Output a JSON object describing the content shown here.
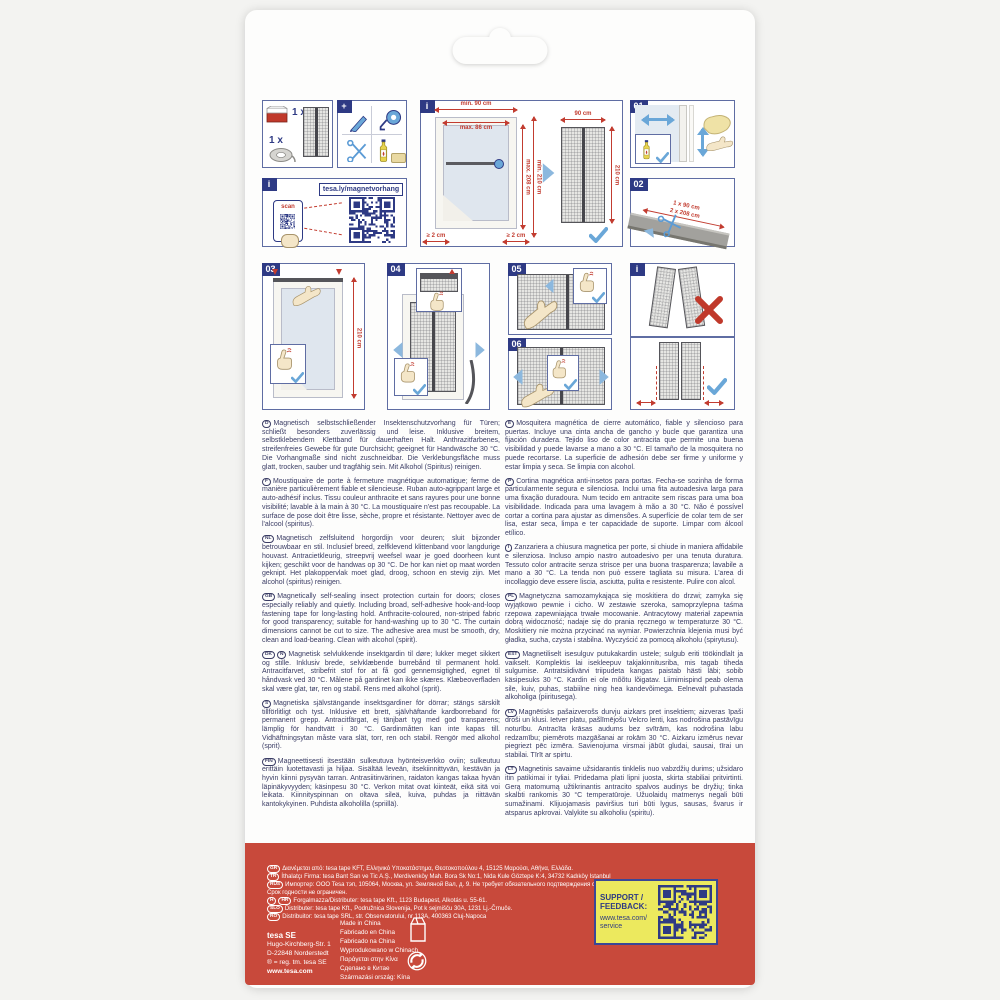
{
  "colors": {
    "footer_red": "#c8493b",
    "panel_navy": "#2e3a84",
    "dim_red": "#c23c30",
    "arrow_blue": "#6aa7d8",
    "support_yellow": "#ece95e",
    "text_navy": "#3a3c64"
  },
  "panels": {
    "contents": {
      "qty_curtain": "1 x",
      "qty_tape": "1 x"
    },
    "tools": {
      "plus": "+"
    },
    "qr": {
      "badge": "i",
      "url": "tesa.ly/magnetvorhang",
      "scan": "scan"
    },
    "measure": {
      "badge": "i",
      "min_width": "min. 90 cm",
      "max_width": "max. 86 cm",
      "min_height": "min. 210 cm",
      "max_height": "max. 208 cm",
      "gap_left": "≥ 2 cm",
      "gap_right": "≥ 2 cm",
      "curtain_width": "90 cm",
      "curtain_height": "210 cm"
    },
    "step01": {
      "num": "01"
    },
    "step02": {
      "num": "02",
      "cut_width": "1 x 90 cm",
      "cut_height": "2 x 208 cm"
    },
    "step03": {
      "num": "03",
      "height": "210 cm"
    },
    "step04": {
      "num": "04"
    },
    "step05": {
      "num": "05"
    },
    "step06": {
      "num": "06"
    },
    "hint": {
      "badge": "i"
    }
  },
  "descriptions": [
    {
      "lang": "D",
      "text": "Magnetisch selbstschließender Insektenschutzvorhang für Türen; schließt besonders zuverlässig und leise. Inklusive breitem, selbstklebendem Klettband für dauerhaften Halt. Anthrazitfarbenes, streifenfreies Gewebe für gute Durchsicht; geeignet für Handwäsche 30 °C. Die Vorhangmaße sind nicht zuschneidbar. Die Verklebungsfläche muss glatt, trocken, sauber und tragfähig sein. Mit Alkohol (Spiritus) reinigen."
    },
    {
      "lang": "F",
      "text": "Moustiquaire de porte à fermeture magnétique automatique; ferme de manière particulièrement fiable et silencieuse. Ruban auto-agrippant large et auto-adhésif inclus. Tissu couleur anthracite et sans rayures pour une bonne visibilité; lavable à la main à 30 °C. La moustiquaire n'est pas recoupable. La surface de pose doit être lisse, sèche, propre et résistante. Nettoyer avec de l'alcool (spiritus)."
    },
    {
      "lang": "NL",
      "text": "Magnetisch zelfsluitend horgordijn voor deuren; sluit bijzonder betrouwbaar en stil. Inclusief breed, zelfklevend klittenband voor langdurige houvast. Antracietkleurig, streepvrij weefsel waar je goed doorheen kunt kijken; geschikt voor de handwas op 30 °C. De hor kan niet op maat worden geknipt. Het plakoppervlak moet glad, droog, schoon en stevig zijn. Met alcohol (spiritus) reinigen."
    },
    {
      "lang": "GB",
      "text": "Magnetically self-sealing insect protection curtain for doors; closes especially reliably and quietly. Including broad, self-adhesive hook-and-loop fastening tape for long-lasting hold. Anthracite-coloured, non-striped fabric for good transparency; suitable for hand-washing up to 30 °C. The curtain dimensions cannot be cut to size. The adhesive area must be smooth, dry, clean and load-bearing. Clean with alcohol (spirit)."
    },
    {
      "lang": "DK",
      "lang2": "N",
      "text": "Magnetisk selvlukkende insektgardin til døre; lukker meget sikkert og stille. Inklusiv brede, selvklæbende burrebånd til permanent hold. Antracitfarvet, stribefrit stof for at få god gennemsigtighed, egnet til håndvask ved 30 °C. Målene på gardinet kan ikke skæres. Klæbeoverfladen skal være glat, tør, ren og stabil. Rens med alkohol (sprit)."
    },
    {
      "lang": "S",
      "text": "Magnetiska självstängande insektsgardiner för dörrar; stängs särskilt tillförlitligt och tyst. Inklusive ett brett, självhäftande kardborreband för permanent grepp. Antracitfärgat, ej tänjbart tyg med god transparens; lämplig för handtvätt i 30 °C. Gardinmåtten kan inte kapas till. Vidhäftningsytan måste vara slät, torr, ren och stabil. Rengör med alkohol (sprit)."
    },
    {
      "lang": "FIN",
      "text": "Magneettisesti itsestään sulkeutuva hyönteisverkko oviin; sulkeutuu erittäin luotettavasti ja hiljaa. Sisältää leveän, itsekiinnittyvän, kestävän ja hyvin kiinni pysyvän tarran. Antrasiitinvärinen, raidaton kangas takaa hyvän läpinäkyvyyden; käsinpesu 30 °C. Verkon mitat ovat kiinteät, eikä sitä voi leikata. Kiinnityspinnan on oltava sileä, kuiva, puhdas ja riittävän kantokykyinen. Puhdista alkoholilla (spriillä)."
    },
    {
      "lang": "E",
      "text": "Mosquitera magnética de cierre automático, fiable y silencioso para puertas. Incluye una cinta ancha de gancho y bucle que garantiza una fijación duradera. Tejido liso de color antracita que permite una buena visibilidad y puede lavarse a mano a 30 °C. El tamaño de la mosquitera no puede recortarse. La superficie de adhesión debe ser firme y uniforme y estar limpia y seca. Se limpia con alcohol."
    },
    {
      "lang": "P",
      "text": "Cortina magnética anti-insetos para portas. Fecha-se sozinha de forma particularmente segura e silenciosa. Inclui uma fita autoadesiva larga para uma fixação duradoura. Num tecido em antracite sem riscas para uma boa visibilidade. Indicada para uma lavagem à mão a 30 °C. Não é possível cortar a cortina para ajustar as dimensões. A superfície de colar tem de ser lisa, estar seca, limpa e ter capacidade de suporte. Limpar com álcool etílico."
    },
    {
      "lang": "I",
      "text": "Zanzariera a chiusura magnetica per porte, si chiude in maniera affidabile e silenziosa. Incluso ampio nastro autoadesivo per una tenuta duratura. Tessuto color antracite senza strisce per una buona trasparenza; lavabile a mano a 30 °C. La tenda non può essere tagliata su misura. L'area di incollaggio deve essere liscia, asciutta, pulita e resistente. Pulire con alcol."
    },
    {
      "lang": "PL",
      "text": "Magnetyczna samozamykająca się moskitiera do drzwi; zamyka się wyjątkowo pewnie i cicho. W zestawie szeroka, samoprzylepna taśma rzepowa zapewniająca trwałe mocowanie. Antracytowy materiał zapewnia dobrą widoczność; nadaje się do prania ręcznego w temperaturze 30 °C. Moskitiery nie można przycinać na wymiar. Powierzchnia klejenia musi być gładka, sucha, czysta i stabilna. Wyczyścić za pomocą alkoholu (spirytusu)."
    },
    {
      "lang": "EST",
      "text": "Magnetiliselt isesulguv putukakardin ustele; sulgub eriti töökindlalt ja vaikselt. Komplektis lai isekleepuv takjakinnitusriba, mis tagab tiheda sulgumise. Antratsiidivärvi triipudeta kangas paistab hästi läbi; sobib käsipesuks 30 °C. Kardin ei ole mõõtu lõigatav. Liimimispind peab olema sile, kuiv, puhas, stabiilne ning hea kandevõimega. Eelnevalt puhastada alkoholiga (piiritusega)."
    },
    {
      "lang": "LV",
      "text": "Magnētisks pašaizverošs durvju aizkars pret insektiem; aizveras īpaši droši un klusi. Ietver platu, pašlīmējošu Velcro lenti, kas nodrošina pastāvīgu noturību. Antracīta krāsas audums bez svītrām, kas nodrošina labu redzamību; piemērots mazgāšanai ar rokām 30 °C. Aizkaru izmērus nevar piegriezt pēc izmēra. Savienojuma virsmai jābūt gludai, sausai, tīrai un stabilai. Tīrīt ar spirtu."
    },
    {
      "lang": "LT",
      "text": "Magnetinis savaime užsidarantis tinklelis nuo vabzdžių durims; užsidaro itin patikimai ir tyliai. Pridedama plati lipni juosta, skirta stabiliai pritvirtinti. Gerą matomumą užtikrinantis antracito spalvos audinys be dryžių; tinka skalbti rankomis 30 °C temperatūroje. Užuolaidų matmenys negali būti sumažinami. Klijuojamasis paviršius turi būti lygus, sausas, švarus ir atsparus apkrovai. Valykite su alkoholiu (spiritu)."
    }
  ],
  "footer": {
    "distributors": [
      {
        "lang": "GR",
        "text": "Διανέμεται από: tesa tape KFT, Ελληνικό Υποκατάστημα, Θεοτοκοπούλου 4, 15125 Μαρούσι, Αθήνα, Ελλάδα."
      },
      {
        "lang": "TR",
        "text": "İthalatçı Firma: tesa Bant San ve Tic A.Ş., Merdivenköy Mah. Bora Sk No:1, Nida Kule Göztepe K:4, 34732 Kadıköy Istanbul"
      },
      {
        "lang": "RUS",
        "text": "Импортер: ООО Tesa тэп, 105064, Москва, ул. Земляной Вал, д. 9. Не требует обязательного подтверждения соответствия."
      },
      {
        "text": "Срок годности не ограничен."
      },
      {
        "lang": "H",
        "lang2": "HR",
        "text": "Forgalmazza/Distributer: tesa tape Kft., 1123 Budapest, Alkotás u. 55-61."
      },
      {
        "lang": "SLO",
        "text": "Distributer: tesa tape Kft., Podružnica Slovenija, Pot k sejmišču 30A, 1231 Lj.-Črnuče."
      },
      {
        "lang": "RO",
        "text": "Distribuitor: tesa tape SRL, str. Observatorului, nr 113A, 400363 Cluj-Napoca"
      }
    ],
    "company": {
      "name": "tesa SE",
      "address1": "Hugo-Kirchberg-Str. 1",
      "address2": "D-22848 Norderstedt",
      "reg": "® = reg. tm. tesa SE",
      "web": "www.tesa.com"
    },
    "made_in": {
      "0": "Made in China",
      "1": "Fabricado en China",
      "2": "Fabricado na China",
      "3": "Wyprodukowano w Chinach",
      "4": "Παράγεται στην Κίνα",
      "5": "Сделано в Китае",
      "6": "Származási ország: Kína"
    },
    "support": {
      "line1": "SUPPORT /",
      "line2": "FEEDBACK:",
      "line3": "www.tesa.com/",
      "line4": "service"
    }
  }
}
